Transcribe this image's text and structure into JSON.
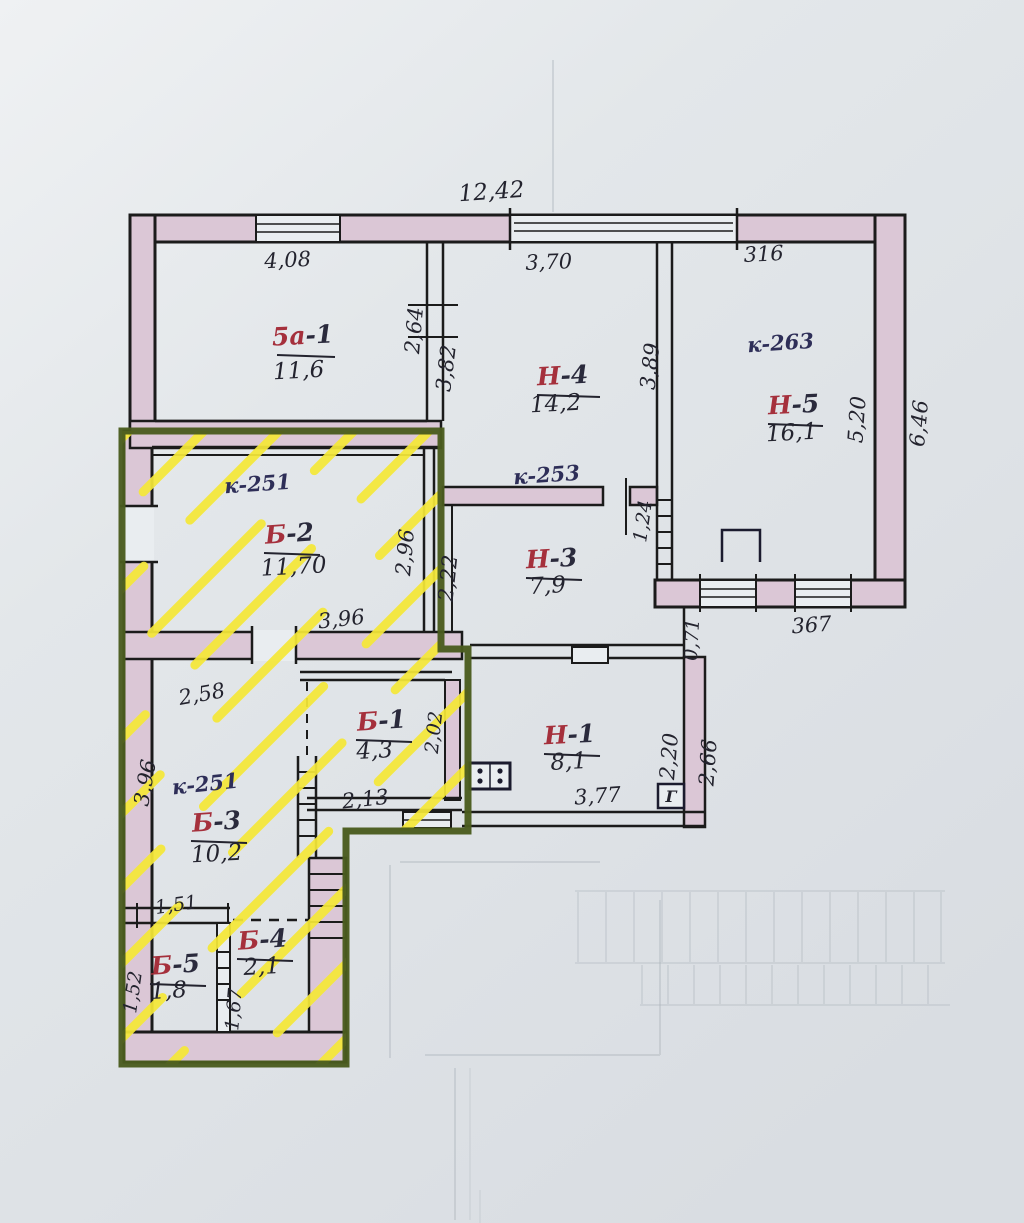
{
  "plan": {
    "highlight_color": "#4a5c1e",
    "hatch_color": "#f5e838",
    "wall_fill": "#dbc7d6",
    "ink_color": "#23232e",
    "red_label_color": "#a5303c",
    "blue_label_color": "#2e2e58"
  },
  "rooms": {
    "r5a1": {
      "prefix": "5а",
      "suffix": "-1",
      "area": "11,6"
    },
    "n4": {
      "prefix": "Н",
      "suffix": "-4",
      "area": "14,2"
    },
    "n5": {
      "prefix": "Н",
      "suffix": "-5",
      "area": "16,1",
      "code": "к-263"
    },
    "b2": {
      "prefix": "Б",
      "suffix": "-2",
      "area": "11,70",
      "code": "к-251"
    },
    "n3": {
      "prefix": "Н",
      "suffix": "-3",
      "area": "7,9",
      "code": "к-253"
    },
    "b1": {
      "prefix": "Б",
      "suffix": "-1",
      "area": "4,3"
    },
    "n1": {
      "prefix": "Н",
      "suffix": "-1",
      "area": "8,1"
    },
    "b3": {
      "prefix": "Б",
      "suffix": "-3",
      "area": "10,2",
      "code": "к-251"
    },
    "b5": {
      "prefix": "Б",
      "suffix": "-5",
      "area": "1,8"
    },
    "b4": {
      "prefix": "Б",
      "suffix": "-4",
      "area": "2,1"
    }
  },
  "dims": {
    "total_top": "12,42",
    "top_left": "4,08",
    "top_mid": "3,70",
    "top_right": "316",
    "v264": "2,64",
    "v382": "3,82",
    "v389": "3,89",
    "v520": "5,20",
    "v646": "6,46",
    "v296": "2,96",
    "v222": "2,22",
    "v124": "1,24",
    "b2_bottom": "3,96",
    "v071": "0,71",
    "n5_bottom": "367",
    "b3_top": "2,58",
    "v202": "2,02",
    "b1_bottom": "2,13",
    "v220": "2,20",
    "v266": "2,66",
    "n1_bottom": "3,77",
    "b3_left": "3,96",
    "b5_top": "1,51",
    "b5_left": "1,52",
    "b4_inner": "1,67"
  },
  "symbols": {
    "gas_label": "Г"
  }
}
